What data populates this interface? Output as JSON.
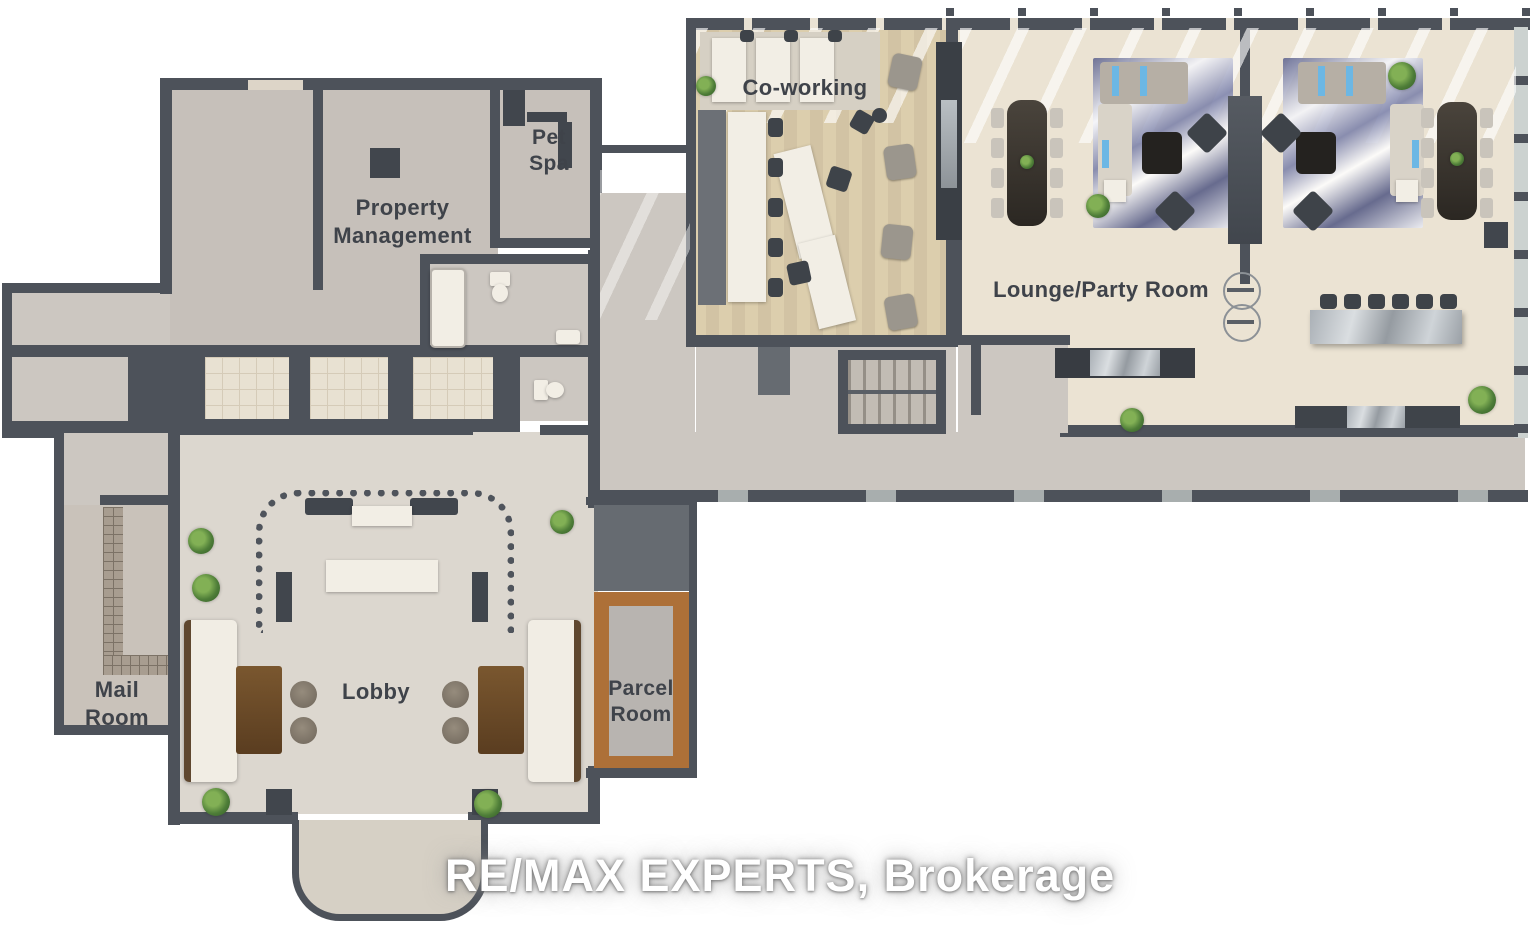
{
  "watermark": {
    "text": "RE/MAX EXPERTS, Brokerage"
  },
  "rooms": {
    "coworking": {
      "label": "Co-working"
    },
    "lounge_party": {
      "label": "Lounge/Party Room"
    },
    "property_management": {
      "label": "Property\nManagement"
    },
    "pet_spa": {
      "label": "Pet\nSpa"
    },
    "mail_room": {
      "label": "Mail\nRoom"
    },
    "lobby": {
      "label": "Lobby"
    },
    "parcel_room": {
      "label": "Parcel\nRoom"
    }
  },
  "palette": {
    "wall": "#4d525a",
    "floor_gray": "#ccc7c1",
    "floor_room": "#c6c0ba",
    "floor_lobby": "#dcd7cf",
    "floor_lounge": "#ebe3d3",
    "floor_wood": "#d7c8aa",
    "elevator_tile": "#e8e1d2",
    "parcel_wood": "#ad7038",
    "rug_blue": "#787ea8",
    "pillow_blue": "#6cb7e4",
    "plant_green": "#4e7d38",
    "table_wood": "#6f4f2e",
    "label_text": "#3f434a",
    "watermark_text": "#ffffff"
  }
}
